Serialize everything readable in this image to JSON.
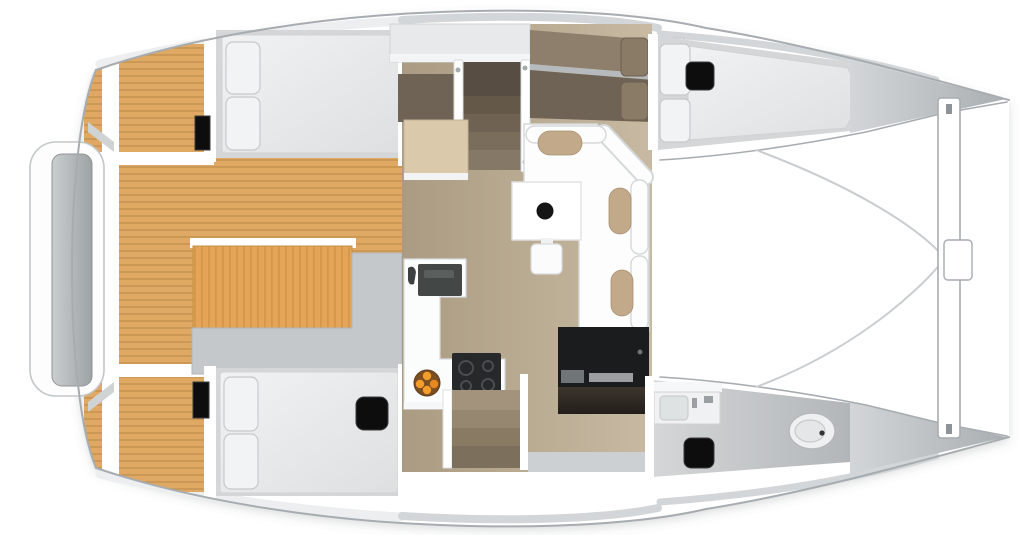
{
  "title": "Catamaran interior layout floor plan, top-down view: aft teak cockpit, two aft double cabins, salon with L-shaped sofa and table, L-shaped galley with sink and cooktop, forward double berth, bathroom with toilet, bow trampoline with crossbeam",
  "colors": {
    "hull_line": "#a6acb0",
    "deck_band": "#d2d6d8",
    "rim_band": "#eceeef",
    "wall_white": "#ffffff",
    "teak": "#dfa963",
    "teak_line": "#bd8d4c",
    "orange_table": "#e4a558",
    "orange_line": "#d2964b",
    "bench_gray": "#c5c8ca",
    "platform_gray": "#b2b6b8",
    "cabin_floor": "#d4d6d7",
    "mattress": "#e8eaeb",
    "pillow": "#f2f3f4",
    "pillow_line": "#c6c9cb",
    "salon_floor": "#b3a38b",
    "salon_floor_light": "#c8baa2",
    "upholstery_light": "#8d7f6c",
    "upholstery_dark": "#6f6355",
    "stair_dark": "#574d42",
    "wood_table": "#dbc9ab",
    "sofa_white": "#fdfdfe",
    "sofa_line": "#d5d8d9",
    "cushion_tan": "#c1a989",
    "counter_white": "#fbfcfc",
    "sink_dark": "#434746",
    "cooktop_black": "#26282a",
    "unit_black": "#1a1c1d",
    "plate_brown": "#7c4f23",
    "fruit_orange": "#f59d2a",
    "toilet_white": "#eff0f1",
    "hatch_black": "#0d0d0d",
    "step_gray": "#ccd0d2"
  },
  "regions": {
    "aft_platform": "aft platform",
    "cockpit": "aft cockpit teak deck",
    "cockpit_table": "cockpit table",
    "port_aft_cabin": "port aft double berth",
    "starboard_aft_cabin": "starboard aft double berth",
    "salon": "salon with sofa and table",
    "chart_table": "chart table",
    "galley": "L-shaped galley",
    "forward_berth": "port forward double berth",
    "bathroom": "starboard head with toilet",
    "trampoline": "bow trampoline",
    "crossbeam": "forward crossbeam"
  }
}
